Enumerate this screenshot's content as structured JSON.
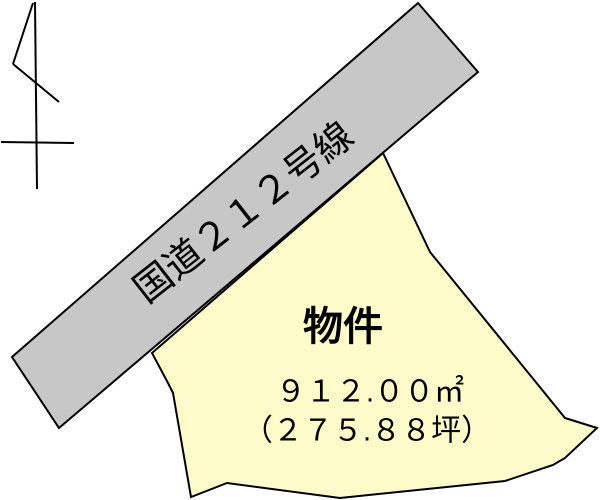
{
  "colors": {
    "background": "#ffffff",
    "outline": "#000000",
    "road_fill": "#c7c7c7",
    "parcel_fill": "#fdfbc9"
  },
  "road": {
    "label": "国道２１２号線"
  },
  "parcel": {
    "title": "物件",
    "area_m2": "９１２.００㎡",
    "area_tsubo": "（２７５.８８坪）"
  }
}
